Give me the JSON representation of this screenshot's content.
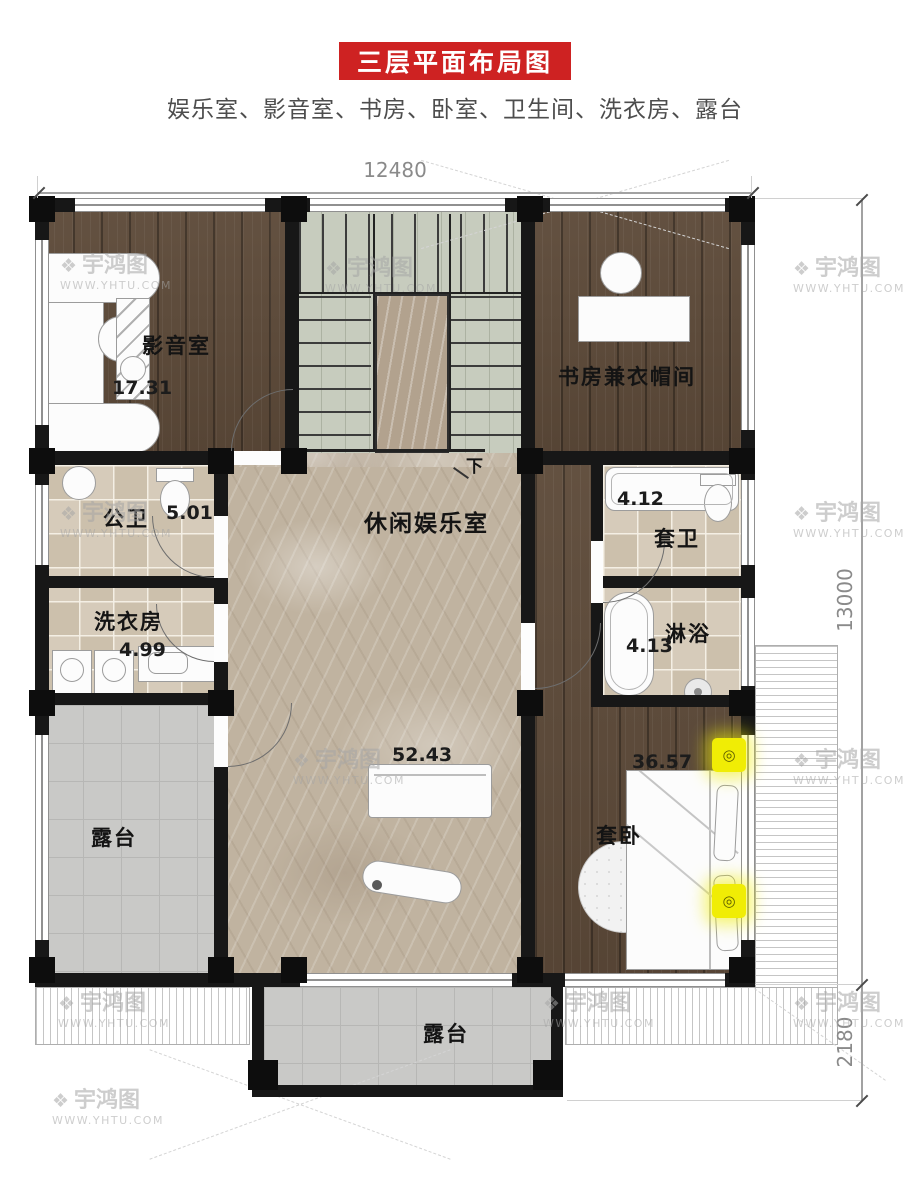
{
  "header": {
    "title": "三层平面布局图",
    "subtitle": "娱乐室、影音室、书房、卧室、卫生间、洗衣房、露台",
    "banner_color": "#ce2222"
  },
  "dimensions": {
    "top_width": "12480",
    "right_main": "13000",
    "right_lower": "2180"
  },
  "rooms": {
    "cinema": {
      "name": "影音室",
      "area": "17.31"
    },
    "study": {
      "name": "书房兼衣帽间"
    },
    "hall": {
      "name": "休闲娱乐室",
      "area": "52.43"
    },
    "public_bath": {
      "name": "公卫",
      "area": "5.01"
    },
    "laundry": {
      "name": "洗衣房",
      "area": "4.99"
    },
    "ensuite_bath": {
      "name": "套卫",
      "area": "4.12"
    },
    "shower": {
      "name": "淋浴",
      "area": "4.13"
    },
    "master_bedroom": {
      "name": "套卧",
      "area": "36.57"
    },
    "terrace_left": {
      "name": "露台"
    },
    "terrace_bottom": {
      "name": "露台"
    }
  },
  "stairs": {
    "down_label": "下"
  },
  "watermark": {
    "brand": "宇鸿图",
    "url": "WWW.YHTU.COM",
    "logo_icon": "❖"
  }
}
